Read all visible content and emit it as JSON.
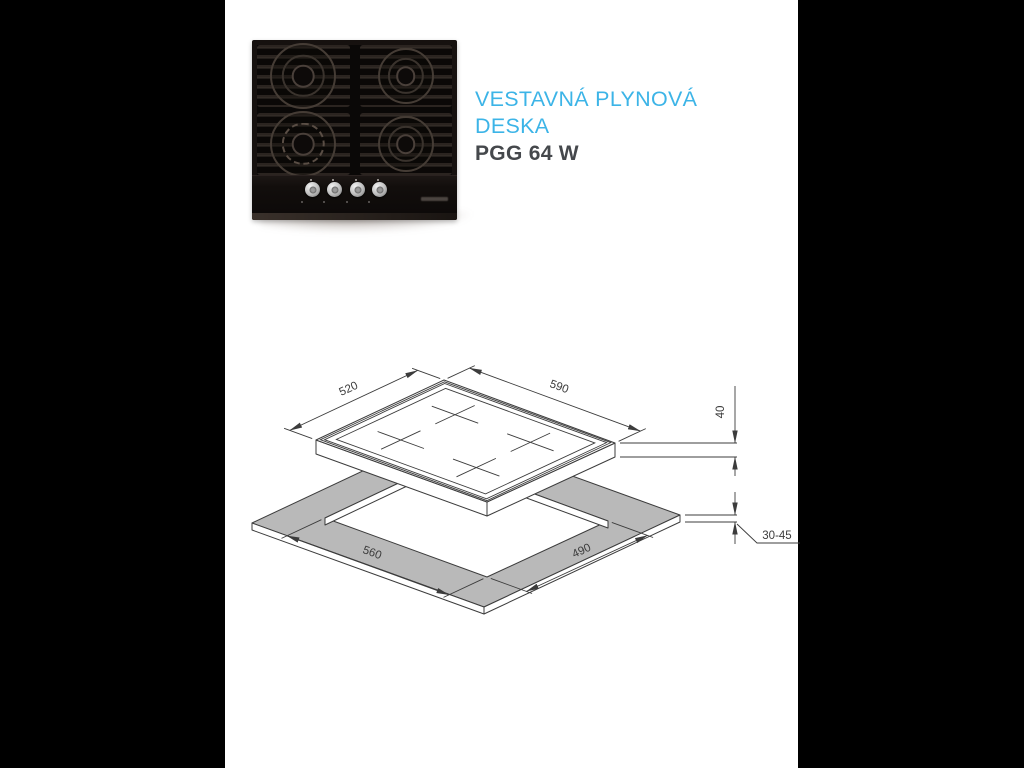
{
  "page": {
    "background": "#000000",
    "content_background": "#ffffff"
  },
  "product": {
    "title_line1": "VESTAVNÁ PLYNOVÁ",
    "title_line2": "DESKA",
    "model": "PGG 64 W"
  },
  "colors": {
    "accent_cyan": "#3cb4e7",
    "model_gray": "#45484c",
    "drawing_line": "#3c3c3c",
    "worktop_fill": "#b9b9b9"
  },
  "drawing": {
    "hob_width_mm": "590",
    "hob_depth_mm": "520",
    "cutout_width_mm": "560",
    "cutout_depth_mm": "490",
    "hob_height_mm": "40",
    "worktop_thickness_mm": "30-45"
  }
}
